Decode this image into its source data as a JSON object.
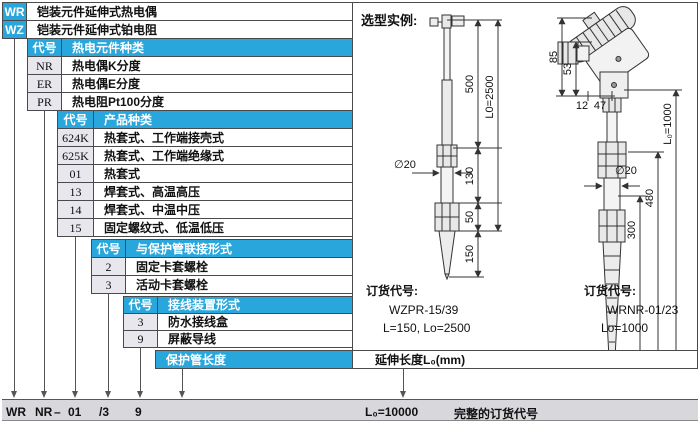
{
  "colors": {
    "accent_blue": "#29a7dc",
    "code_cell_bg": "#e7e7ed",
    "bottom_bar_bg": "#d8d8dc"
  },
  "selector": {
    "root_rows": [
      {
        "code": "WR",
        "desc": "铠装元件延伸式热电偶"
      },
      {
        "code": "WZ",
        "desc": "铠装元件延伸式铂电阻"
      }
    ],
    "levels": [
      {
        "code_header": "代号",
        "title": "热电元件种类",
        "rows": [
          {
            "code": "NR",
            "desc": "热电偶K分度"
          },
          {
            "code": "ER",
            "desc": "热电偶E分度"
          },
          {
            "code": "PR",
            "desc": "热电阻Pt100分度"
          }
        ]
      },
      {
        "code_header": "代号",
        "title": "产品种类",
        "rows": [
          {
            "code": "624K",
            "desc": "热套式、工作端接壳式"
          },
          {
            "code": "625K",
            "desc": "热套式、工作端绝缘式"
          },
          {
            "code": "01",
            "desc": "热套式"
          },
          {
            "code": "13",
            "desc": "焊套式、高温高压"
          },
          {
            "code": "14",
            "desc": "焊套式、中温中压"
          },
          {
            "code": "15",
            "desc": "固定螺纹式、低温低压"
          }
        ]
      },
      {
        "code_header": "代号",
        "title": "与保护管联接形式",
        "rows": [
          {
            "code": "2",
            "desc": "固定卡套螺栓"
          },
          {
            "code": "3",
            "desc": "活动卡套螺栓"
          }
        ]
      },
      {
        "code_header": "代号",
        "title": "接线装置形式",
        "rows": [
          {
            "code": "3",
            "desc": "防水接线盒"
          },
          {
            "code": "9",
            "desc": "屏蔽导线"
          }
        ]
      }
    ],
    "length_row": {
      "label": "保护管长度",
      "extension_label": "延伸长度L₀(mm)"
    }
  },
  "example": {
    "title": "选型实例:",
    "left_drawing": {
      "dim_upper": "500",
      "dim_mid": "130",
      "dim_nut": "50",
      "dim_tip": "150",
      "dim_total": "L0=2500",
      "diameter": "∅20"
    },
    "right_drawing": {
      "dim_head": "85",
      "dim_gland": "53",
      "dim_offset1": "12",
      "dim_offset2": "47",
      "diameter": "∅20",
      "dim_insert": "300",
      "dim_lower": "480",
      "dim_total": "L₀=1000"
    },
    "left_order": {
      "heading": "订货代号:",
      "code": "WZPR-15/39",
      "spec": "L=150, Lo=2500"
    },
    "right_order": {
      "heading": "订货代号:",
      "code": "WRNR-01/23",
      "spec": "Lo=1000"
    }
  },
  "bottom_bar": {
    "codes": [
      "WR",
      "NR",
      "–",
      "01",
      "/3",
      "9"
    ],
    "length_value": "L₀=10000",
    "label": "完整的订货代号"
  }
}
